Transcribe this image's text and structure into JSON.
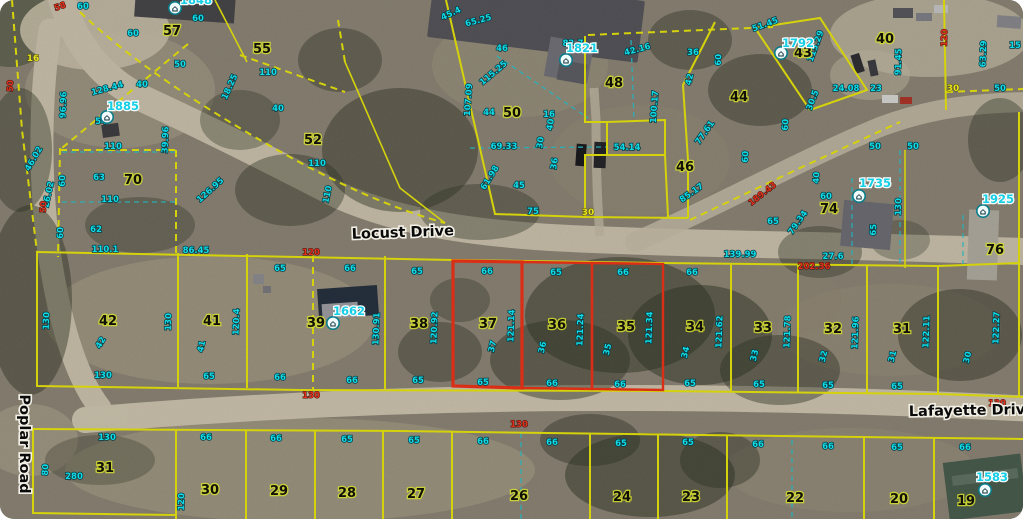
{
  "map": {
    "title": "County GIS parcel aerial view",
    "colors": {
      "boundary_yellow": "#efec08",
      "selected_red": "#f53014",
      "dimension_cyan": "#10dce8",
      "dimension_red": "#e0311c",
      "address_cyan": "#14cfe6",
      "road_surface": "#cfc6b0",
      "terrain": "#8e8677"
    },
    "streets": [
      {
        "name": "Locust Drive",
        "x": 403,
        "y": 237,
        "r": -2
      },
      {
        "name": "Lafayette Drive",
        "x": 972,
        "y": 415,
        "r": -1
      },
      {
        "name": "Poplar Road",
        "x": 20,
        "y": 444,
        "r": 90
      }
    ],
    "selected_parcels": [
      "37",
      "36",
      "35"
    ],
    "parcel_numbers": [
      {
        "t": "57",
        "x": 172,
        "y": 35
      },
      {
        "t": "55",
        "x": 262,
        "y": 53
      },
      {
        "t": "52",
        "x": 313,
        "y": 144
      },
      {
        "t": "70",
        "x": 133,
        "y": 184
      },
      {
        "t": "50",
        "x": 512,
        "y": 117
      },
      {
        "t": "48",
        "x": 614,
        "y": 87
      },
      {
        "t": "46",
        "x": 685,
        "y": 171
      },
      {
        "t": "44",
        "x": 739,
        "y": 101
      },
      {
        "t": "43",
        "x": 803,
        "y": 57
      },
      {
        "t": "40",
        "x": 885,
        "y": 43
      },
      {
        "t": "74",
        "x": 829,
        "y": 213
      },
      {
        "t": "76",
        "x": 995,
        "y": 254
      },
      {
        "t": "42",
        "x": 108,
        "y": 325
      },
      {
        "t": "41",
        "x": 212,
        "y": 325
      },
      {
        "t": "39",
        "x": 316,
        "y": 327
      },
      {
        "t": "38",
        "x": 419,
        "y": 328
      },
      {
        "t": "37",
        "x": 488,
        "y": 328
      },
      {
        "t": "36",
        "x": 557,
        "y": 329
      },
      {
        "t": "35",
        "x": 626,
        "y": 331
      },
      {
        "t": "34",
        "x": 695,
        "y": 331
      },
      {
        "t": "33",
        "x": 763,
        "y": 332
      },
      {
        "t": "32",
        "x": 833,
        "y": 333
      },
      {
        "t": "31",
        "x": 902,
        "y": 333
      },
      {
        "t": "31",
        "x": 105,
        "y": 472
      },
      {
        "t": "30",
        "x": 210,
        "y": 494
      },
      {
        "t": "29",
        "x": 279,
        "y": 495
      },
      {
        "t": "28",
        "x": 347,
        "y": 497
      },
      {
        "t": "27",
        "x": 416,
        "y": 498
      },
      {
        "t": "26",
        "x": 519,
        "y": 500
      },
      {
        "t": "24",
        "x": 622,
        "y": 501
      },
      {
        "t": "23",
        "x": 691,
        "y": 501
      },
      {
        "t": "22",
        "x": 795,
        "y": 502
      },
      {
        "t": "20",
        "x": 899,
        "y": 503
      },
      {
        "t": "19",
        "x": 966,
        "y": 505
      }
    ],
    "addresses": [
      {
        "t": "1885",
        "x": 123,
        "y": 110,
        "ix": 107,
        "iy": 117
      },
      {
        "t": "1821",
        "x": 582,
        "y": 52,
        "ix": 566,
        "iy": 60
      },
      {
        "t": "1792",
        "x": 798,
        "y": 47,
        "ix": 781,
        "iy": 53
      },
      {
        "t": "1735",
        "x": 875,
        "y": 187,
        "ix": 859,
        "iy": 196
      },
      {
        "t": "1925",
        "x": 998,
        "y": 203,
        "ix": 983,
        "iy": 211
      },
      {
        "t": "1662",
        "x": 349,
        "y": 315,
        "ix": 333,
        "iy": 323
      },
      {
        "t": "1583",
        "x": 992,
        "y": 481,
        "ix": 985,
        "iy": 490
      },
      {
        "t": "1848",
        "x": 196,
        "y": 4,
        "ix": 175,
        "iy": 8
      }
    ],
    "dimensions_cyan": [
      {
        "t": "60",
        "x": 83,
        "y": 9
      },
      {
        "t": "60",
        "x": 198,
        "y": 21
      },
      {
        "t": "60",
        "x": 133,
        "y": 36
      },
      {
        "t": "50",
        "x": 180,
        "y": 67
      },
      {
        "t": "40",
        "x": 142,
        "y": 87
      },
      {
        "t": "110",
        "x": 268,
        "y": 75
      },
      {
        "t": "18.25",
        "x": 232,
        "y": 88,
        "r": -65
      },
      {
        "t": "96.96",
        "x": 66,
        "y": 105,
        "r": -88
      },
      {
        "t": "128.44",
        "x": 108,
        "y": 91,
        "r": -15
      },
      {
        "t": "54",
        "x": 101,
        "y": 124
      },
      {
        "t": "110",
        "x": 113,
        "y": 149
      },
      {
        "t": "39.96",
        "x": 168,
        "y": 140,
        "r": -88
      },
      {
        "t": "40",
        "x": 278,
        "y": 111
      },
      {
        "t": "110",
        "x": 317,
        "y": 166
      },
      {
        "t": "110",
        "x": 330,
        "y": 195,
        "r": -78
      },
      {
        "t": "63",
        "x": 99,
        "y": 180
      },
      {
        "t": "60",
        "x": 65,
        "y": 181,
        "r": -88
      },
      {
        "t": "110",
        "x": 110,
        "y": 202
      },
      {
        "t": "62",
        "x": 96,
        "y": 232
      },
      {
        "t": "60",
        "x": 63,
        "y": 233,
        "r": -88
      },
      {
        "t": "110.1",
        "x": 105,
        "y": 252
      },
      {
        "t": "126.95",
        "x": 212,
        "y": 192,
        "r": -42
      },
      {
        "t": "46.02",
        "x": 36,
        "y": 160,
        "r": -60
      },
      {
        "t": "26.02",
        "x": 51,
        "y": 195,
        "r": -78
      },
      {
        "t": "45.4",
        "x": 452,
        "y": 16,
        "r": -25
      },
      {
        "t": "65.25",
        "x": 479,
        "y": 23,
        "r": -15
      },
      {
        "t": "46",
        "x": 502,
        "y": 51
      },
      {
        "t": "115.25",
        "x": 495,
        "y": 75,
        "r": -40
      },
      {
        "t": "107.09",
        "x": 471,
        "y": 100,
        "r": -86
      },
      {
        "t": "44",
        "x": 489,
        "y": 115
      },
      {
        "t": "16",
        "x": 549,
        "y": 117
      },
      {
        "t": "82.7",
        "x": 573,
        "y": 46
      },
      {
        "t": "42.16",
        "x": 638,
        "y": 52,
        "r": -15
      },
      {
        "t": "100.17",
        "x": 657,
        "y": 107,
        "r": -86
      },
      {
        "t": "40",
        "x": 553,
        "y": 125,
        "r": -80
      },
      {
        "t": "69.33",
        "x": 504,
        "y": 149
      },
      {
        "t": "30",
        "x": 543,
        "y": 143,
        "r": -82
      },
      {
        "t": "36",
        "x": 557,
        "y": 164,
        "r": -82
      },
      {
        "t": "61.98",
        "x": 492,
        "y": 179,
        "r": -58
      },
      {
        "t": "45",
        "x": 519,
        "y": 188
      },
      {
        "t": "54.14",
        "x": 627,
        "y": 150
      },
      {
        "t": "75",
        "x": 533,
        "y": 214
      },
      {
        "t": "85.17",
        "x": 693,
        "y": 195,
        "r": -35
      },
      {
        "t": "77.61",
        "x": 707,
        "y": 134,
        "r": -55
      },
      {
        "t": "60",
        "x": 748,
        "y": 157,
        "r": -86
      },
      {
        "t": "60",
        "x": 788,
        "y": 125,
        "r": -86
      },
      {
        "t": "36",
        "x": 693,
        "y": 55
      },
      {
        "t": "51.45",
        "x": 766,
        "y": 27,
        "r": -20
      },
      {
        "t": "115.29",
        "x": 818,
        "y": 47,
        "r": -70
      },
      {
        "t": "60",
        "x": 721,
        "y": 60,
        "r": -86
      },
      {
        "t": "42",
        "x": 692,
        "y": 80,
        "r": -76
      },
      {
        "t": "24.08",
        "x": 846,
        "y": 91
      },
      {
        "t": "23",
        "x": 876,
        "y": 91
      },
      {
        "t": "30.5",
        "x": 815,
        "y": 101,
        "r": -70
      },
      {
        "t": "50",
        "x": 1000,
        "y": 91
      },
      {
        "t": "63.29",
        "x": 986,
        "y": 54,
        "r": -88
      },
      {
        "t": "91.45",
        "x": 901,
        "y": 62,
        "r": -88
      },
      {
        "t": "15",
        "x": 1015,
        "y": 48
      },
      {
        "t": "50",
        "x": 875,
        "y": 149
      },
      {
        "t": "50",
        "x": 913,
        "y": 149
      },
      {
        "t": "40",
        "x": 819,
        "y": 178,
        "r": -86
      },
      {
        "t": "60",
        "x": 826,
        "y": 199
      },
      {
        "t": "65",
        "x": 773,
        "y": 224
      },
      {
        "t": "79.34",
        "x": 800,
        "y": 224,
        "r": -55
      },
      {
        "t": "139.99",
        "x": 740,
        "y": 257
      },
      {
        "t": "27.6",
        "x": 833,
        "y": 259
      },
      {
        "t": "130",
        "x": 901,
        "y": 207,
        "r": -88
      },
      {
        "t": "65",
        "x": 876,
        "y": 230,
        "r": -86
      },
      {
        "t": "86.45",
        "x": 196,
        "y": 253
      },
      {
        "t": "65",
        "x": 280,
        "y": 271
      },
      {
        "t": "66",
        "x": 350,
        "y": 271
      },
      {
        "t": "65",
        "x": 417,
        "y": 274
      },
      {
        "t": "66",
        "x": 487,
        "y": 274
      },
      {
        "t": "65",
        "x": 556,
        "y": 275
      },
      {
        "t": "66",
        "x": 623,
        "y": 275
      },
      {
        "t": "66",
        "x": 692,
        "y": 275
      },
      {
        "t": "130",
        "x": 49,
        "y": 321,
        "r": -88
      },
      {
        "t": "130",
        "x": 171,
        "y": 322,
        "r": -88
      },
      {
        "t": "120.4",
        "x": 239,
        "y": 322,
        "r": -88
      },
      {
        "t": "130.91",
        "x": 379,
        "y": 329,
        "r": -88
      },
      {
        "t": "120.92",
        "x": 437,
        "y": 328,
        "r": -88
      },
      {
        "t": "121.14",
        "x": 514,
        "y": 326,
        "r": -88
      },
      {
        "t": "121.24",
        "x": 583,
        "y": 330,
        "r": -88
      },
      {
        "t": "121.34",
        "x": 652,
        "y": 328,
        "r": -88
      },
      {
        "t": "121.62",
        "x": 722,
        "y": 332,
        "r": -88
      },
      {
        "t": "121.78",
        "x": 790,
        "y": 332,
        "r": -88
      },
      {
        "t": "121.96",
        "x": 858,
        "y": 333,
        "r": -88
      },
      {
        "t": "122.11",
        "x": 929,
        "y": 332,
        "r": -88
      },
      {
        "t": "122.27",
        "x": 999,
        "y": 328,
        "r": -88
      },
      {
        "t": "42",
        "x": 103,
        "y": 344,
        "r": -60
      },
      {
        "t": "41",
        "x": 204,
        "y": 347,
        "r": -76
      },
      {
        "t": "37",
        "x": 495,
        "y": 347,
        "r": -76
      },
      {
        "t": "36",
        "x": 545,
        "y": 348,
        "r": -76
      },
      {
        "t": "35",
        "x": 610,
        "y": 350,
        "r": -76
      },
      {
        "t": "34",
        "x": 688,
        "y": 353,
        "r": -76
      },
      {
        "t": "33",
        "x": 757,
        "y": 356,
        "r": -76
      },
      {
        "t": "32",
        "x": 826,
        "y": 357,
        "r": -76
      },
      {
        "t": "31",
        "x": 895,
        "y": 357,
        "r": -76
      },
      {
        "t": "30",
        "x": 970,
        "y": 358,
        "r": -76
      },
      {
        "t": "130",
        "x": 103,
        "y": 378
      },
      {
        "t": "65",
        "x": 209,
        "y": 379
      },
      {
        "t": "66",
        "x": 280,
        "y": 380
      },
      {
        "t": "66",
        "x": 352,
        "y": 383
      },
      {
        "t": "65",
        "x": 418,
        "y": 383
      },
      {
        "t": "65",
        "x": 483,
        "y": 385
      },
      {
        "t": "66",
        "x": 552,
        "y": 386
      },
      {
        "t": "66",
        "x": 620,
        "y": 387
      },
      {
        "t": "65",
        "x": 690,
        "y": 386
      },
      {
        "t": "65",
        "x": 759,
        "y": 387
      },
      {
        "t": "65",
        "x": 828,
        "y": 388
      },
      {
        "t": "65",
        "x": 897,
        "y": 389
      },
      {
        "t": "130",
        "x": 107,
        "y": 440
      },
      {
        "t": "280",
        "x": 74,
        "y": 479
      },
      {
        "t": "80",
        "x": 48,
        "y": 470,
        "r": -86
      },
      {
        "t": "66",
        "x": 206,
        "y": 440
      },
      {
        "t": "66",
        "x": 276,
        "y": 441
      },
      {
        "t": "65",
        "x": 347,
        "y": 442
      },
      {
        "t": "65",
        "x": 414,
        "y": 443
      },
      {
        "t": "66",
        "x": 483,
        "y": 444
      },
      {
        "t": "66",
        "x": 552,
        "y": 445
      },
      {
        "t": "65",
        "x": 621,
        "y": 446
      },
      {
        "t": "65",
        "x": 688,
        "y": 445
      },
      {
        "t": "66",
        "x": 758,
        "y": 447
      },
      {
        "t": "66",
        "x": 828,
        "y": 449
      },
      {
        "t": "65",
        "x": 897,
        "y": 450
      },
      {
        "t": "66",
        "x": 965,
        "y": 450
      },
      {
        "t": "120",
        "x": 184,
        "y": 502,
        "r": -88
      }
    ],
    "dimensions_red": [
      {
        "t": "58",
        "x": 61,
        "y": 9,
        "r": -20
      },
      {
        "t": "50",
        "x": 13,
        "y": 86,
        "r": -88
      },
      {
        "t": "50",
        "x": 46,
        "y": 207,
        "r": -88
      },
      {
        "t": "120",
        "x": 311,
        "y": 255
      },
      {
        "t": "189.43",
        "x": 764,
        "y": 196,
        "r": -38
      },
      {
        "t": "202.36",
        "x": 814,
        "y": 269
      },
      {
        "t": "120",
        "x": 947,
        "y": 38,
        "r": -88
      },
      {
        "t": "130",
        "x": 311,
        "y": 398
      },
      {
        "t": "130",
        "x": 519,
        "y": 427
      },
      {
        "t": "130",
        "x": 997,
        "y": 406
      }
    ],
    "dimensions_yellow": [
      {
        "t": "30",
        "x": 588,
        "y": 215
      },
      {
        "t": "30",
        "x": 953,
        "y": 91
      },
      {
        "t": "16",
        "x": 33,
        "y": 61
      }
    ]
  }
}
